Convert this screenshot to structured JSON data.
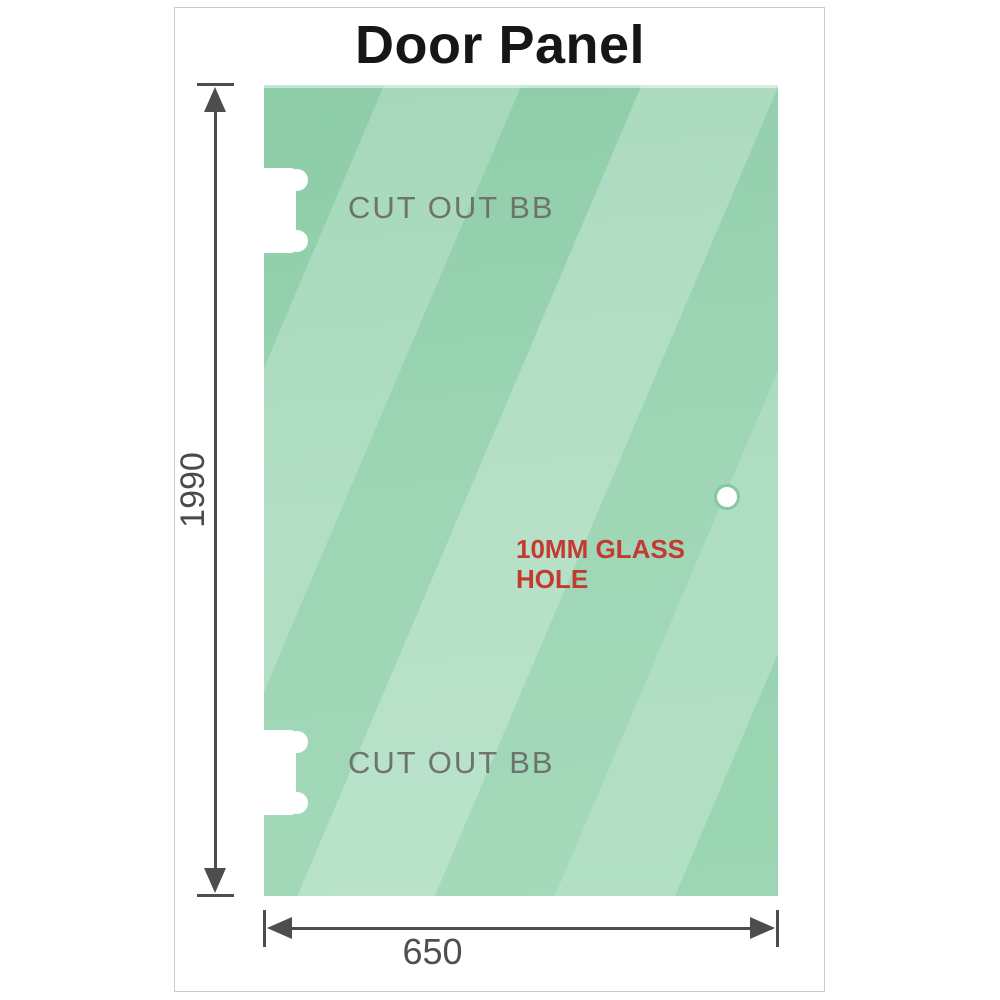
{
  "title": "Door Panel",
  "glass_panel": {
    "cutouts": [
      {
        "label": "CUT OUT BB",
        "position": "top-left"
      },
      {
        "label": "CUT OUT BB",
        "position": "bottom-left"
      }
    ],
    "hole": {
      "label": "10MM GLASS HOLE"
    }
  },
  "dimensions": {
    "height": {
      "value": "1990"
    },
    "width": {
      "value": "650"
    }
  },
  "colors": {
    "glass_base": "#8fd0aa",
    "glass_highlight": "#c9e9d6",
    "cutout_fill": "#ffffff",
    "hole_ring": "#86c8a2",
    "dimension_lines": "#4d4d4d",
    "cutout_label_text": "#6e736e",
    "hole_label_text": "#c43a30",
    "title_text": "#161616",
    "frame_border": "#cbcbcb",
    "background": "#ffffff"
  }
}
